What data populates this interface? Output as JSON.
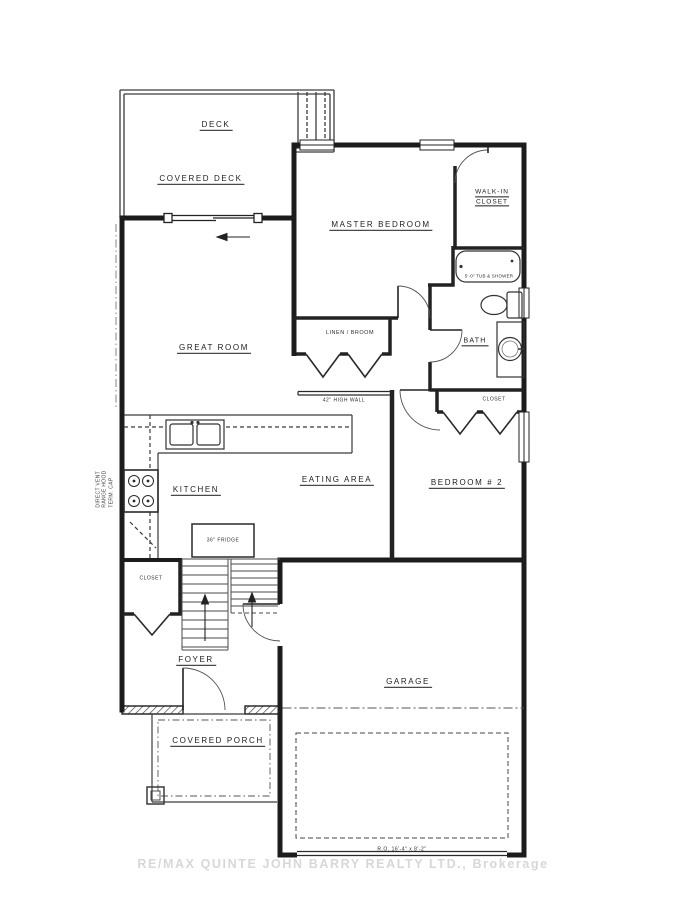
{
  "plan": {
    "labels": {
      "deck": "DECK",
      "covered_deck": "COVERED DECK",
      "master_bedroom": "MASTER BEDROOM",
      "walk_in_closet_1": "WALK-IN",
      "walk_in_closet_2": "CLOSET",
      "great_room": "GREAT ROOM",
      "linen_broom": "LINEN / BROOM",
      "bath": "BATH",
      "kitchen": "KITCHEN",
      "eating_area": "EATING AREA",
      "bedroom_2": "BEDROOM # 2",
      "closet_bedroom_2": "CLOSET",
      "closet_foyer": "CLOSET",
      "foyer": "FOYER",
      "garage": "GARAGE",
      "covered_porch": "COVERED PORCH"
    },
    "annotations": {
      "half_wall": "42\" HIGH WALL",
      "fridge": "36\" FRIDGE",
      "tub": "5'-0\" TUB & SHOWER",
      "garage_door_opening": "R.O. 16'-4\" x 8'-2\"",
      "vent_1": "DIRECT VENT",
      "vent_2": "RANGE HOOD",
      "vent_3": "TERM. CAP"
    },
    "watermark": "RE/MAX QUINTE JOHN BARRY REALTY LTD., Brokerage",
    "colors": {
      "wall": "#1c1c1c",
      "line": "#3a3a3a",
      "paper": "#ffffff",
      "watermark": "#bdbdbd"
    }
  }
}
